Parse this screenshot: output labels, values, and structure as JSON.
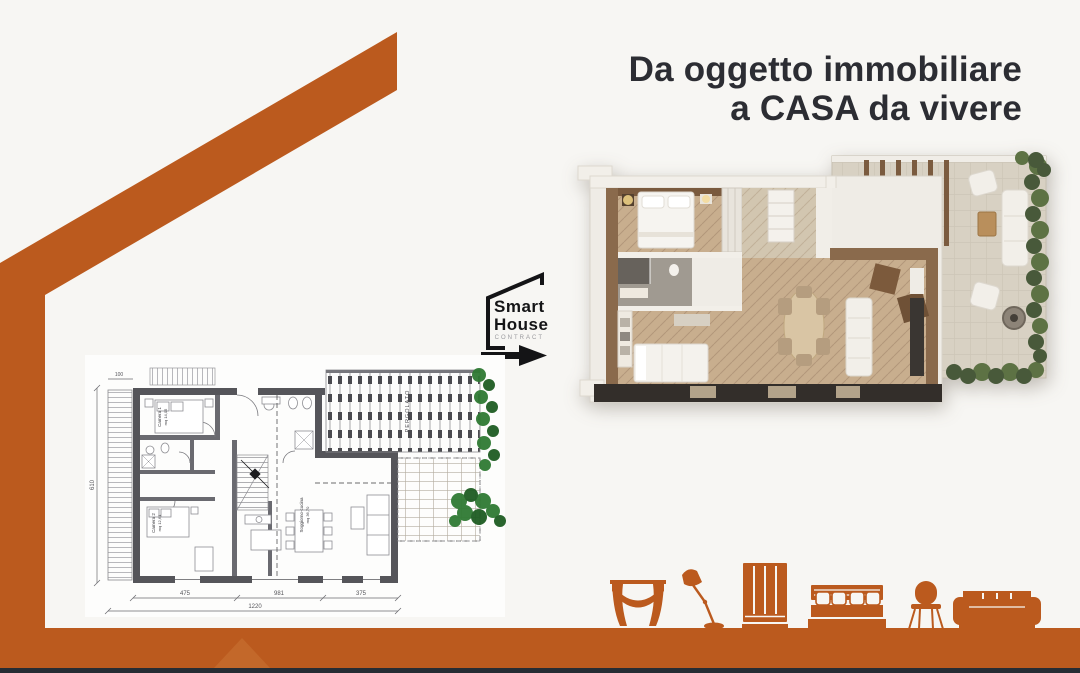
{
  "colors": {
    "accent_orange": "#bb5a1e",
    "background": "#f7f6f3",
    "headline_text": "#2c2d33",
    "footer_dark_line": "#262c34",
    "plan_wall_gray": "#55555a",
    "render_wood": "#c8ae8e",
    "render_terrace": "#d8d1c3",
    "hedge_green": "#2f7a33"
  },
  "headline": {
    "line1": "Da oggetto immobiliare",
    "line2": "a CASA da vivere"
  },
  "logo": {
    "line1": "Smart",
    "line2": "House",
    "subtitle": "CONTRACT"
  },
  "floorplan": {
    "labels": {
      "pergolato": "PERGOLATO",
      "camera1": "Camera 1",
      "camera1_mq": "mq 14,05",
      "camera2": "Camera 2",
      "camera2_mq": "mq 12,64",
      "soggiorno": "Soggiorno-cucina",
      "soggiorno_mq": "mq 36,70"
    },
    "dimensions": {
      "left": "610",
      "top": "100",
      "seg1": "475",
      "seg2": "981",
      "seg3": "375",
      "total": "1220"
    }
  },
  "furniture_icons": [
    "curtain-icon",
    "lamp-icon",
    "wardrobe-icon",
    "bed-icon",
    "chair-icon",
    "sofa-icon"
  ]
}
